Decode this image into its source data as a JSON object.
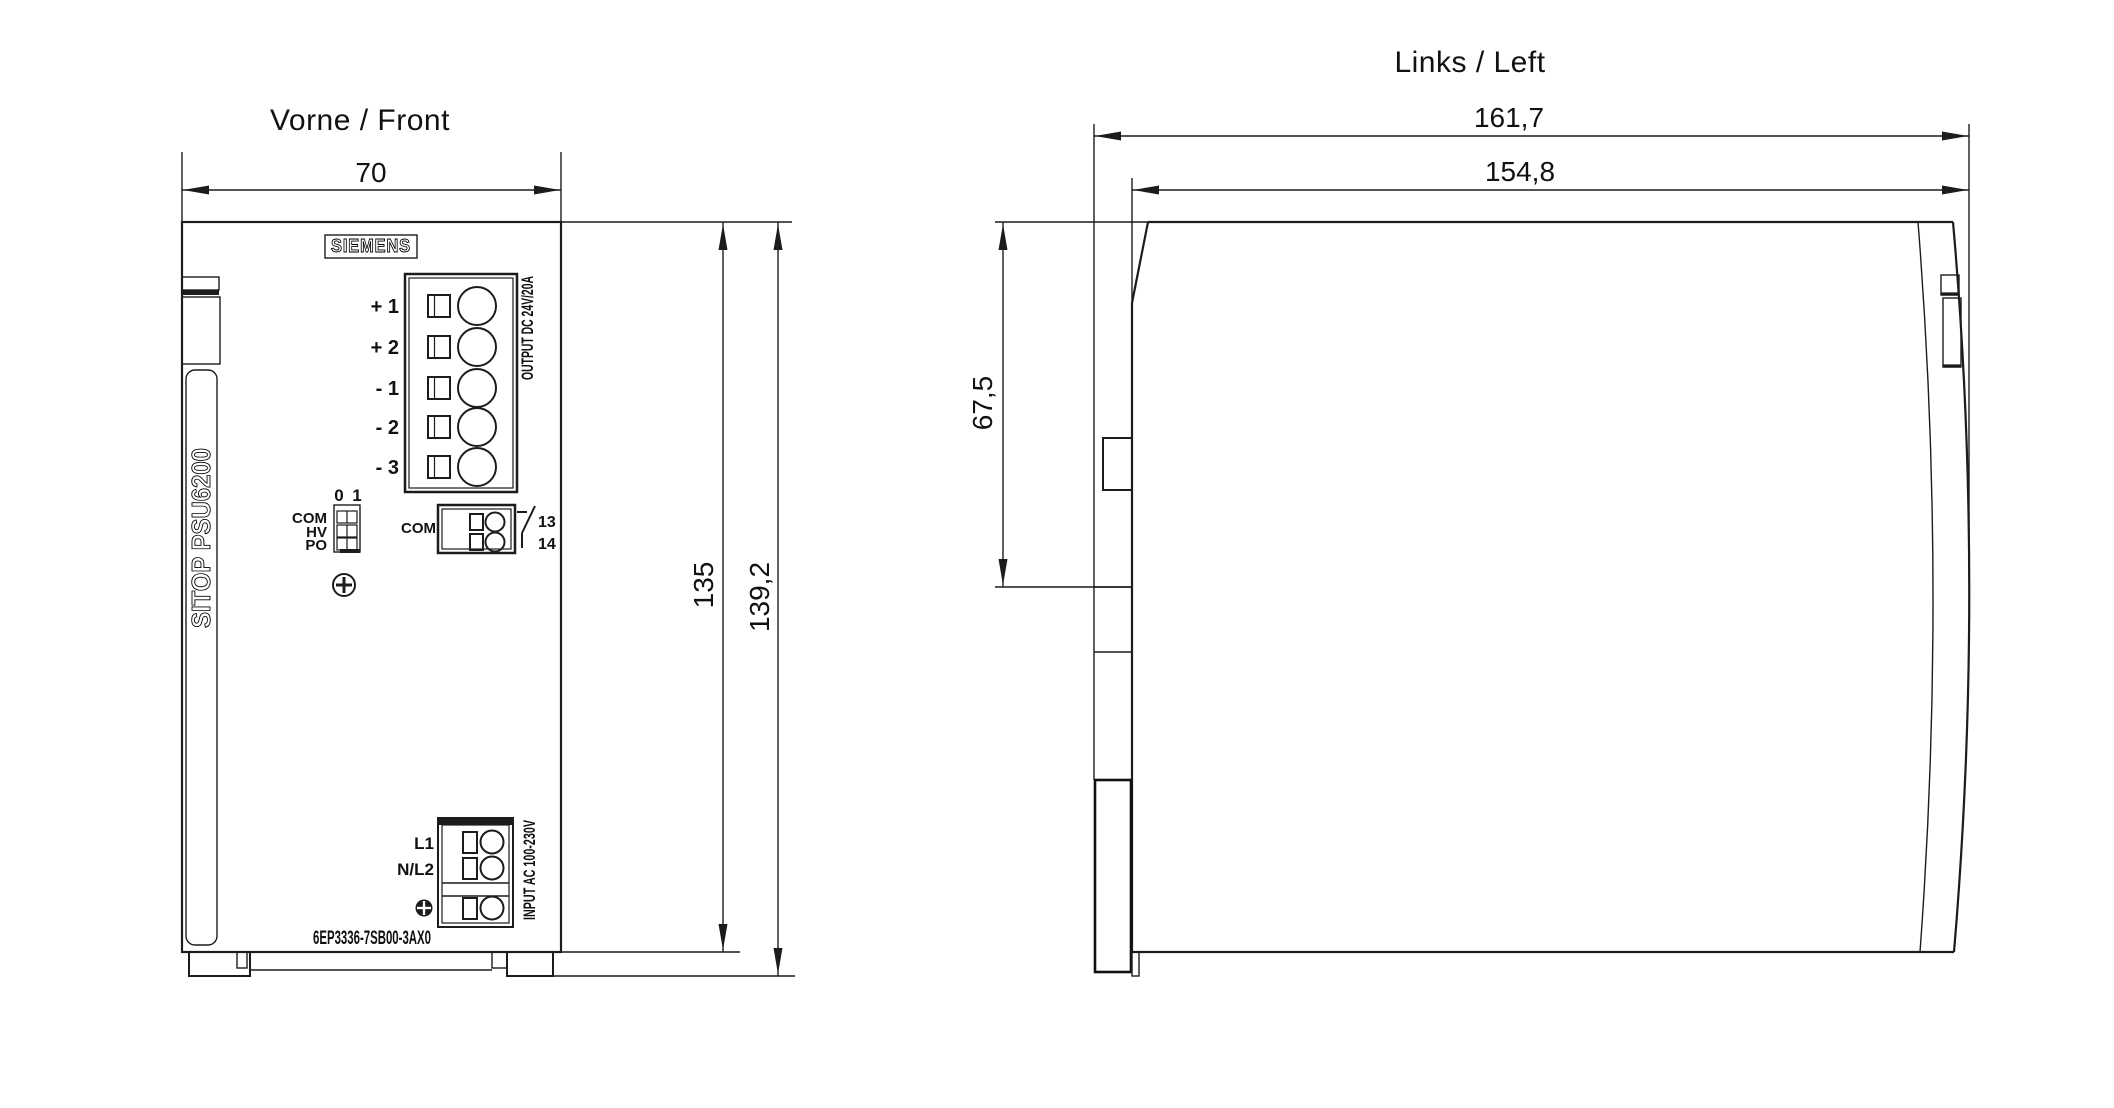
{
  "drawing": {
    "front": {
      "title": "Vorne / Front",
      "width_dim": "70",
      "height_dim": "135",
      "total_height_dim": "139,2",
      "brand": "SIEMENS",
      "product": "SITOP PSU6200",
      "output": {
        "label": "OUTPUT DC 24V/20A",
        "terminals": [
          "+ 1",
          "+ 2",
          "- 1",
          "- 2",
          "- 3"
        ]
      },
      "dip": {
        "pos0": "0",
        "pos1": "1",
        "switches": [
          "COM",
          "HV",
          "PO"
        ]
      },
      "relay": {
        "label": "COM",
        "contact_top": "13",
        "contact_bottom": "14"
      },
      "input": {
        "label": "INPUT AC 100-230V",
        "line": "L1",
        "neutral": "N/L2"
      },
      "part_number": "6EP3336-7SB00-3AX0"
    },
    "left": {
      "title": "Links / Left",
      "total_depth_dim": "161,7",
      "body_depth_dim": "154,8",
      "top_offset_dim": "67,5"
    }
  }
}
